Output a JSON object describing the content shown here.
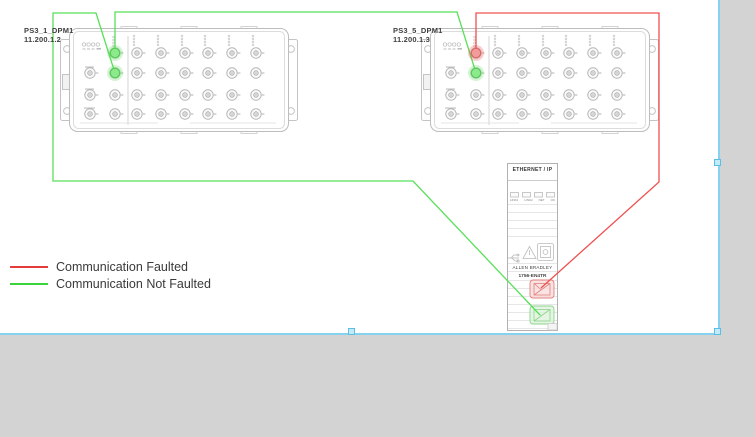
{
  "devices": [
    {
      "label": "PS3_1_DPM1",
      "ip": "11.200.1.2",
      "highlighted_ports": [
        {
          "row": 1,
          "status": "not_faulted"
        },
        {
          "row": 2,
          "status": "not_faulted"
        }
      ]
    },
    {
      "label": "PS3_5_DPM1",
      "ip": "11.200.1.3",
      "highlighted_ports": [
        {
          "row": 1,
          "status": "faulted"
        },
        {
          "row": 2,
          "status": "not_faulted"
        }
      ]
    }
  ],
  "ethernet_module": {
    "header": "ETHERNET / IP",
    "indicator_labels": [
      "LINK1",
      "LINK2",
      "NET",
      "OK"
    ],
    "brand": "ALLEN BRADLEY",
    "model": "1756-EN4TR",
    "ports": [
      {
        "position": "upper",
        "status": "faulted"
      },
      {
        "position": "lower",
        "status": "not_faulted"
      }
    ]
  },
  "connections": [
    {
      "from": "PS3_1_DPM1",
      "to": "1756-EN4TR",
      "status": "not_faulted"
    },
    {
      "from": "PS3_1_DPM1",
      "to": "PS3_5_DPM1",
      "status": "not_faulted"
    },
    {
      "from": "PS3_5_DPM1",
      "to": "1756-EN4TR",
      "status": "faulted"
    }
  ],
  "legend": {
    "items": [
      {
        "label": "Communication Faulted",
        "status": "faulted",
        "color": "#e23c3c"
      },
      {
        "label": "Communication Not Faulted",
        "status": "not_faulted",
        "color": "#3bd43b"
      }
    ]
  },
  "colors": {
    "faulted_line": "#ef5050",
    "not_faulted_line": "#58e058",
    "selection_border": "#85d1ee",
    "workspace_gray": "#d3d3d3",
    "device_outline": "#bdbdbd"
  }
}
